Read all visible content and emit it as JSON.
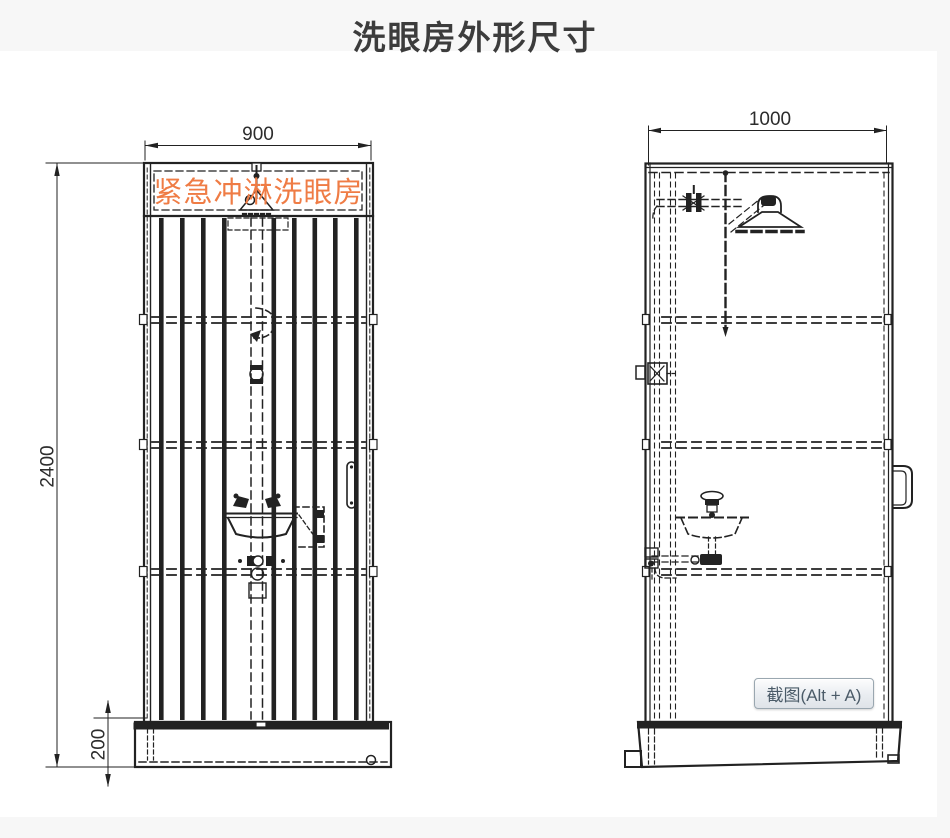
{
  "page": {
    "title": "洗眼房外形尺寸"
  },
  "front_view": {
    "sign_label": "紧急冲淋洗眼房",
    "width_dim": "900",
    "height_dim": "2400",
    "base_height_dim": "200"
  },
  "side_view": {
    "width_dim": "1000"
  },
  "overlay": {
    "screenshot_button_label": "截图(Alt + A)"
  },
  "colors": {
    "sign_text": "#ef7c45",
    "drawing_line": "#222222",
    "dimension_text": "#2c2c2c",
    "title_text": "#3c3c3c",
    "strip_background": "#f7f7f7",
    "page_background": "#ffffff",
    "button_border": "#9aa7b0",
    "button_text": "#4b5b68"
  }
}
